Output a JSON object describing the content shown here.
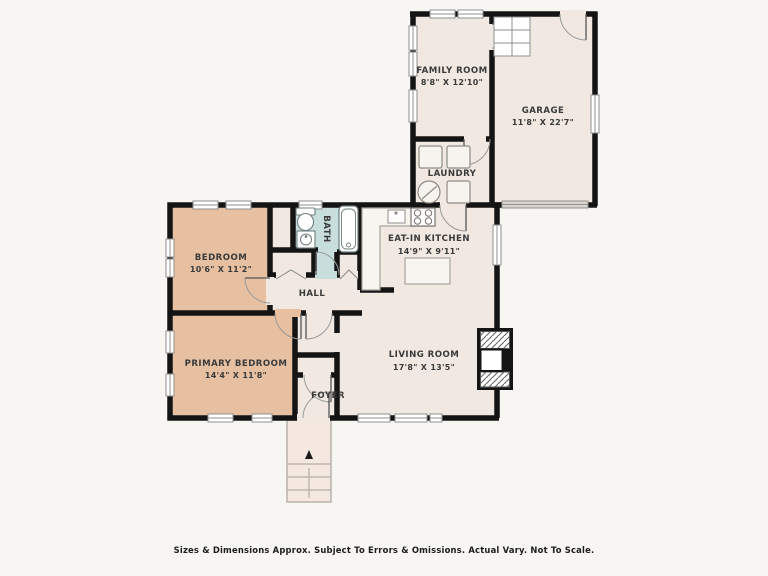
{
  "rooms": {
    "family_room": {
      "name": "FAMILY ROOM",
      "dims": "8'8\" X 12'10\""
    },
    "garage": {
      "name": "GARAGE",
      "dims": "11'8\" X 22'7\""
    },
    "laundry": {
      "name": "LAUNDRY"
    },
    "kitchen": {
      "name": "EAT-IN KITCHEN",
      "dims": "14'9\" X 9'11\""
    },
    "bath": {
      "name": "BATH"
    },
    "hall": {
      "name": "HALL"
    },
    "bedroom": {
      "name": "BEDROOM",
      "dims": "10'6\" X 11'2\""
    },
    "primary_bedroom": {
      "name": "PRIMARY BEDROOM",
      "dims": "14'4\" X 11'8\""
    },
    "living_room": {
      "name": "LIVING ROOM",
      "dims": "17'8\" X 13'5\""
    },
    "foyer": {
      "name": "FOYER"
    }
  },
  "footer": {
    "disclaimer": "Sizes & Dimensions Approx. Subject To Errors & Omissions. Actual Vary. Not To Scale."
  },
  "colors": {
    "background": "#f7f6f3",
    "room_fill": "#f1e9e1",
    "bedroom_fill": "#e7c0a2",
    "bath_fill": "#c7dedd",
    "stoop_fill": "#f4e8e0",
    "wall": "#141414",
    "garage_door": "#d8d4cf"
  }
}
